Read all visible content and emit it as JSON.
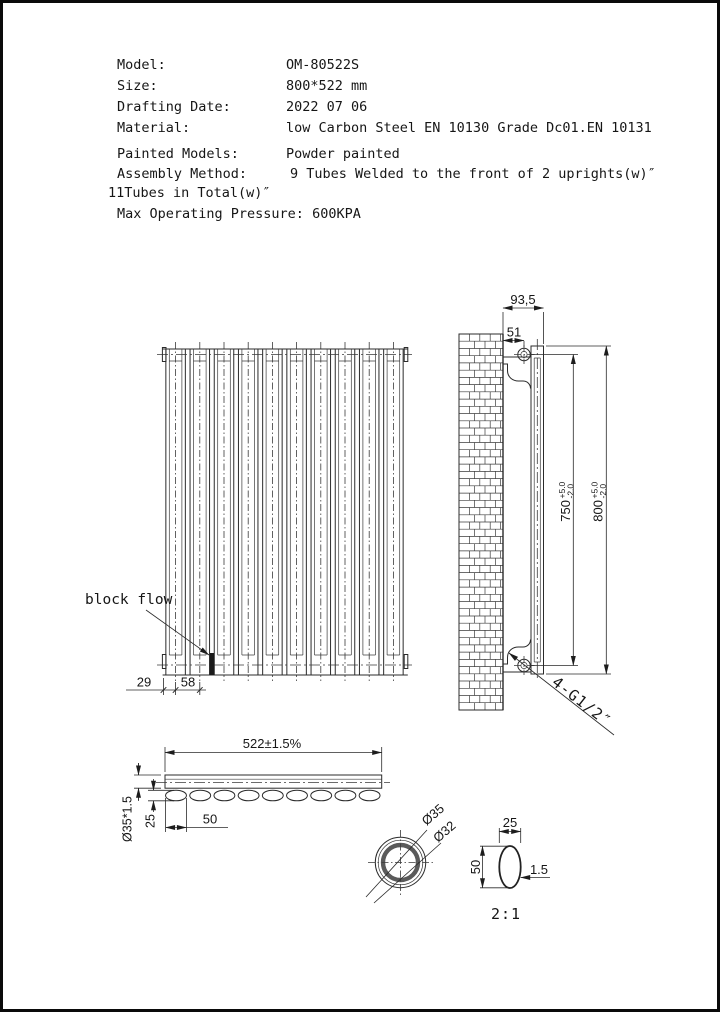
{
  "header": {
    "rows": [
      {
        "label": "Model:",
        "value": "OM-80522S"
      },
      {
        "label": "Size:",
        "value": "800*522 mm"
      },
      {
        "label": "Drafting Date:",
        "value": "2022 07 06"
      },
      {
        "label": "Material:",
        "value": "low Carbon Steel  EN 10130 Grade Dc01.EN 10131"
      },
      {
        "label": "Painted Models:",
        "value": "Powder painted"
      },
      {
        "label": "Assembly Method:",
        "value": "9 Tubes Welded to the front of 2 uprights(w)″"
      }
    ],
    "continuation": "11Tubes in Total(w)″",
    "pressure": "Max Operating Pressure: 600KPA"
  },
  "front_view": {
    "tube_count": 10,
    "block_flow_label": "block flow",
    "dim_edge": "29",
    "dim_pitch": "58"
  },
  "side_view": {
    "dim_depth": "93,5",
    "dim_hole_offset": "51",
    "dim_hole_spacing": {
      "value": "750",
      "plus": "+5.0",
      "minus": "-2.0"
    },
    "dim_height": {
      "value": "800",
      "plus": "+5.0",
      "minus": "-2.0"
    },
    "connection_label": "4-G1/2″"
  },
  "bottom_view": {
    "tube_count": 9,
    "dim_width": "522±1.5%",
    "dim_upright_tube": "Ø35*1.5",
    "dim_tube_depth": "25",
    "dim_tube_width": "50"
  },
  "detail_views": {
    "dim_outer": "Ø35",
    "dim_inner": "Ø32",
    "oval_width": "25",
    "oval_height": "50",
    "oval_wall": "1.5",
    "scale_label": "2:1"
  }
}
